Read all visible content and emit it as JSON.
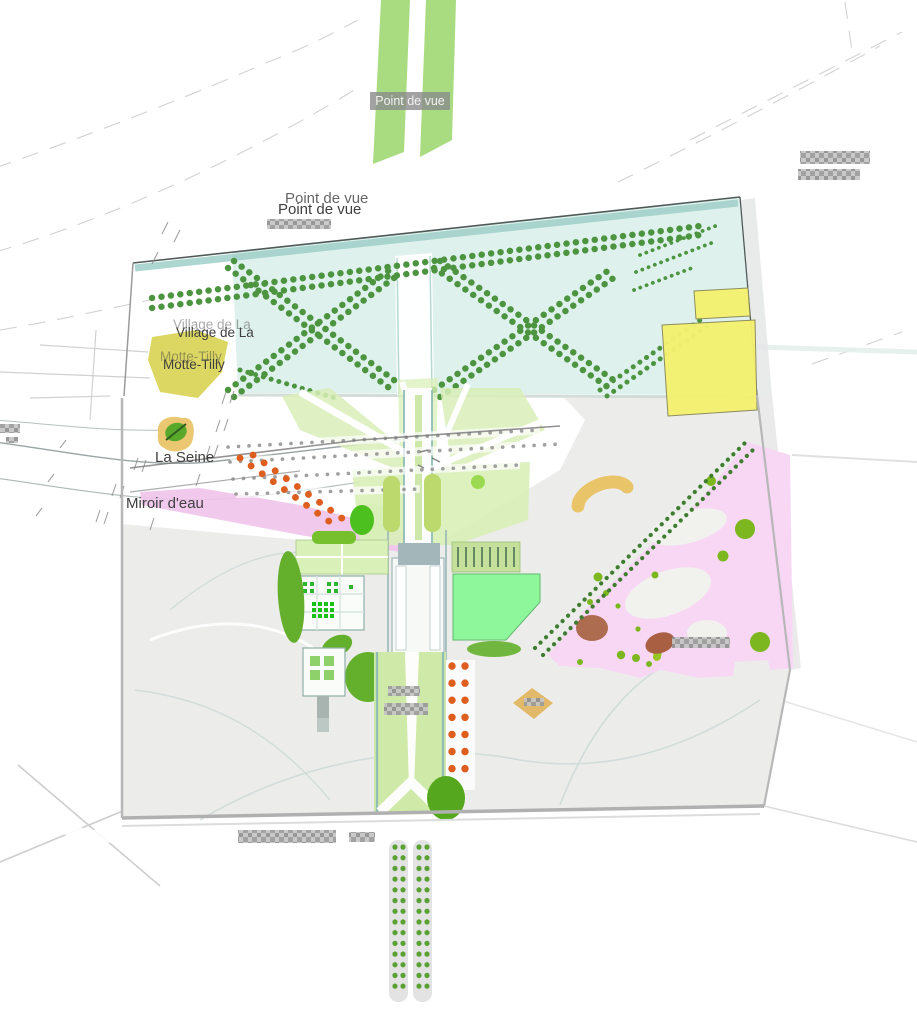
{
  "labels": {
    "point_de_vue_top": "Point de vue",
    "point_de_vue_valley": "Point de vue",
    "village_line1": "Village de La",
    "village_line2": "Motte-Tilly",
    "la_seine": "La Seine",
    "miroir_d_eau": "Miroir d'eau"
  },
  "colors": {
    "page_bg": "#ffffff",
    "contour_line": "#cdcdcd",
    "strip_green": "#a9dc80",
    "label_box_gray": "#8b8b8b",
    "label_text_light": "#f2f2f2",
    "text_dark": "#3f3f3f",
    "cyan_zone": "#def1ec",
    "teal_band": "#9fd0c8",
    "border_dark": "#4f5a58",
    "park_edge": "#b7b7b7",
    "tree_dot": "#4d9440",
    "yellow_field": "#f4f170",
    "village_yellow": "#d9d455",
    "gray_park": "#ececeb",
    "path_blue": "#ccd8d6",
    "river_line": "#9aa4a4",
    "pink_band": "#efc3eb",
    "pink_forest": "#f8d7f5",
    "clearing_white": "#f1f1ee",
    "orange_dot": "#dd5e1f",
    "tan_arc": "#e9c468",
    "tan_diamond": "#e2b968",
    "brown_blob": "#ad6b50",
    "lime_dot": "#7cb71f",
    "wedge_green": "#d9efb8",
    "avenue_edge": "#8fbcb4",
    "olive_capsule": "#bcd96e",
    "parterre_green": "#d9f0b8",
    "mint_parterre": "#8ef79b",
    "tree_blob": "#64b02c",
    "dark_tree": "#55a81e",
    "col_dot_green": "#5aa133",
    "strip_gray": "#e3e3e3",
    "gray_dot": "#8f8f8f",
    "diag_tree_dot": "#3e7d30",
    "pixel_gray": "#9c9c9c"
  }
}
